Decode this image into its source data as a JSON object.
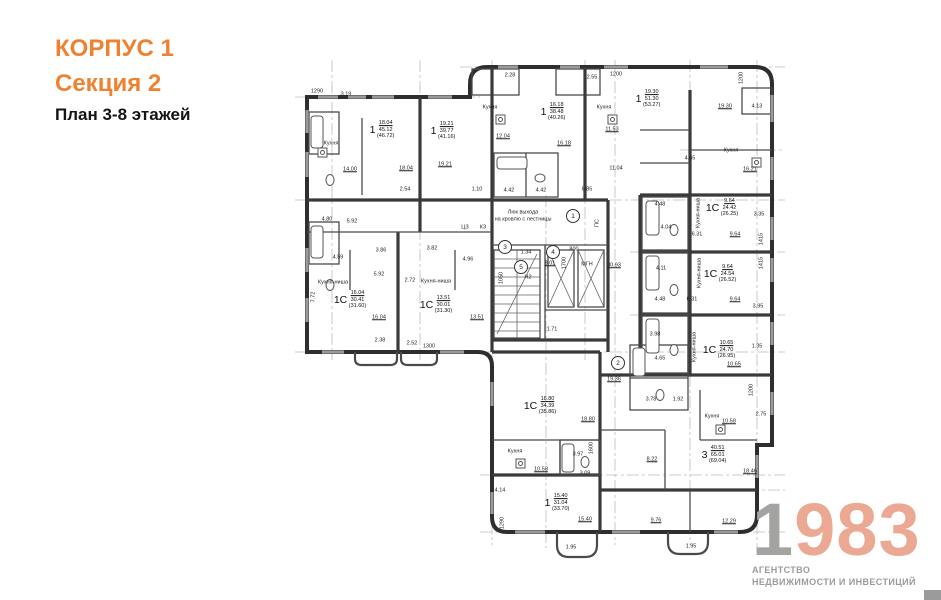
{
  "header": {
    "building": "КОРПУС 1",
    "section": "Секция 2",
    "plan_title": "План 3-8 этажей"
  },
  "logo": {
    "digit1": "1",
    "digits": "983",
    "tagline1": "АГЕНТСТВО",
    "tagline2": "НЕДВИЖИМОСТИ И ИНВЕСТИЦИЙ"
  },
  "colors": {
    "accent": "#ee8230",
    "logo_salmon": "#eba893",
    "logo_gray": "#9b9b9b",
    "ink": "#2e2e2e"
  },
  "plan": {
    "apartments": [
      {
        "type": "1",
        "a1": "18.04",
        "a2": "45.12",
        "a3": "(46.72)",
        "x": 382,
        "y": 130
      },
      {
        "type": "1",
        "a1": "19.21",
        "a2": "39.77",
        "a3": "(41.16)",
        "x": 443,
        "y": 131
      },
      {
        "type": "1",
        "a1": "16.18",
        "a2": "38.48",
        "a3": "(40.26)",
        "x": 553,
        "y": 112
      },
      {
        "type": "1",
        "a1": "19.30",
        "a2": "51.30",
        "a3": "(53.27)",
        "x": 648,
        "y": 99
      },
      {
        "type": "1С",
        "a1": "9.64",
        "a2": "24.42",
        "a3": "(26.25)",
        "x": 722,
        "y": 208
      },
      {
        "type": "1С",
        "a1": "9.64",
        "a2": "24.54",
        "a3": "(26.52)",
        "x": 720,
        "y": 274
      },
      {
        "type": "1С",
        "a1": "10.65",
        "a2": "24.70",
        "a3": "(26.95)",
        "x": 719,
        "y": 350
      },
      {
        "type": "3",
        "a1": "40.51",
        "a2": "65.01",
        "a3": "(69.04)",
        "x": 714,
        "y": 455
      },
      {
        "type": "1С",
        "a1": "18.80",
        "a2": "34.39",
        "a3": "(35.86)",
        "x": 540,
        "y": 406
      },
      {
        "type": "1",
        "a1": "15.40",
        "a2": "31.04",
        "a3": "(33.70)",
        "x": 557,
        "y": 503
      },
      {
        "type": "1С",
        "a1": "16.04",
        "a2": "30.41",
        "a3": "(31.60)",
        "x": 350,
        "y": 300
      },
      {
        "type": "1С",
        "a1": "13.51",
        "a2": "30.01",
        "a3": "(31.30)",
        "x": 436,
        "y": 305
      }
    ],
    "labels": [
      {
        "t": "1290",
        "x": 317,
        "y": 92
      },
      {
        "t": "3.19",
        "x": 346,
        "y": 95
      },
      {
        "t": "Кухня",
        "x": 331,
        "y": 144
      },
      {
        "t": "14.00",
        "x": 350,
        "y": 170,
        "u": 1
      },
      {
        "t": "18.04",
        "x": 406,
        "y": 169,
        "u": 1
      },
      {
        "t": "2.54",
        "x": 405,
        "y": 190
      },
      {
        "t": "19.21",
        "x": 445,
        "y": 165,
        "u": 1
      },
      {
        "t": "1.10",
        "x": 477,
        "y": 190
      },
      {
        "t": "4.80",
        "x": 327,
        "y": 220
      },
      {
        "t": "5.92",
        "x": 352,
        "y": 222
      },
      {
        "t": "4.59",
        "x": 338,
        "y": 258
      },
      {
        "t": "3.86",
        "x": 381,
        "y": 251
      },
      {
        "t": "3.82",
        "x": 432,
        "y": 249
      },
      {
        "t": "4.96",
        "x": 468,
        "y": 260
      },
      {
        "t": "5.92",
        "x": 379,
        "y": 275
      },
      {
        "t": "2.72",
        "x": 410,
        "y": 281
      },
      {
        "t": "7.72",
        "x": 314,
        "y": 297,
        "v": 1
      },
      {
        "t": "Кухня-ниша",
        "x": 333,
        "y": 283
      },
      {
        "t": "Кухня-ниша",
        "x": 436,
        "y": 282
      },
      {
        "t": "16.04",
        "x": 379,
        "y": 318,
        "u": 1
      },
      {
        "t": "13.51",
        "x": 477,
        "y": 318,
        "u": 1
      },
      {
        "t": "2.38",
        "x": 380,
        "y": 341
      },
      {
        "t": "2.52",
        "x": 412,
        "y": 344
      },
      {
        "t": "1300",
        "x": 429,
        "y": 347
      },
      {
        "t": "2.28",
        "x": 510,
        "y": 76
      },
      {
        "t": "Кухня",
        "x": 490,
        "y": 108
      },
      {
        "t": "12.04",
        "x": 503,
        "y": 137,
        "u": 1
      },
      {
        "t": "16.18",
        "x": 564,
        "y": 144,
        "u": 1
      },
      {
        "t": "2.55",
        "x": 592,
        "y": 78
      },
      {
        "t": "1200",
        "x": 616,
        "y": 75
      },
      {
        "t": "Кухня",
        "x": 604,
        "y": 108
      },
      {
        "t": "11.53",
        "x": 612,
        "y": 130,
        "u": 1
      },
      {
        "t": "11.04",
        "x": 616,
        "y": 169
      },
      {
        "t": "6.85",
        "x": 587,
        "y": 190
      },
      {
        "t": "4.42",
        "x": 509,
        "y": 191
      },
      {
        "t": "4.42",
        "x": 541,
        "y": 191
      },
      {
        "t": "ЦЗ",
        "x": 465,
        "y": 228
      },
      {
        "t": "КЗ",
        "x": 483,
        "y": 228
      },
      {
        "t": "1200",
        "x": 742,
        "y": 78,
        "v": 1
      },
      {
        "t": "19.30",
        "x": 725,
        "y": 107,
        "u": 1
      },
      {
        "t": "4.13",
        "x": 757,
        "y": 107
      },
      {
        "t": "Кухня",
        "x": 731,
        "y": 151
      },
      {
        "t": "16.21",
        "x": 750,
        "y": 170,
        "u": 1
      },
      {
        "t": "4.65",
        "x": 690,
        "y": 159
      },
      {
        "t": "4.48",
        "x": 660,
        "y": 205
      },
      {
        "t": "4.04",
        "x": 666,
        "y": 228
      },
      {
        "t": "6.31",
        "x": 697,
        "y": 235
      },
      {
        "t": "9.64",
        "x": 735,
        "y": 235,
        "u": 1
      },
      {
        "t": "3.35",
        "x": 759,
        "y": 215
      },
      {
        "t": "1415",
        "x": 762,
        "y": 239,
        "v": 1
      },
      {
        "t": "1415",
        "x": 762,
        "y": 263,
        "v": 1
      },
      {
        "t": "Кухня-ниша",
        "x": 699,
        "y": 213,
        "v": 1
      },
      {
        "t": "Кухня-ниша",
        "x": 700,
        "y": 273,
        "v": 1
      },
      {
        "t": "4.11",
        "x": 661,
        "y": 269
      },
      {
        "t": "6.31",
        "x": 692,
        "y": 300
      },
      {
        "t": "9.64",
        "x": 735,
        "y": 300,
        "u": 1
      },
      {
        "t": "3.95",
        "x": 758,
        "y": 307
      },
      {
        "t": "4.48",
        "x": 660,
        "y": 300
      },
      {
        "t": "3.98",
        "x": 655,
        "y": 335
      },
      {
        "t": "Кухня-ниша",
        "x": 695,
        "y": 347,
        "v": 1
      },
      {
        "t": "10.65",
        "x": 734,
        "y": 365,
        "u": 1
      },
      {
        "t": "1.35",
        "x": 757,
        "y": 347
      },
      {
        "t": "Люк выхода",
        "x": 523,
        "y": 213
      },
      {
        "t": "на кровлю с лестницы",
        "x": 523,
        "y": 220
      },
      {
        "t": "1.34",
        "x": 526,
        "y": 253
      },
      {
        "t": "8.01",
        "x": 550,
        "y": 264,
        "u": 1
      },
      {
        "t": "800",
        "x": 574,
        "y": 250
      },
      {
        "t": "1700",
        "x": 565,
        "y": 263,
        "v": 1
      },
      {
        "t": "МГН",
        "x": 587,
        "y": 265
      },
      {
        "t": "1050",
        "x": 502,
        "y": 278,
        "v": 1
      },
      {
        "t": "Н2",
        "x": 528,
        "y": 278
      },
      {
        "t": "ПС",
        "x": 598,
        "y": 223,
        "v": 1
      },
      {
        "t": "30.93",
        "x": 614,
        "y": 266,
        "u": 1
      },
      {
        "t": "1.71",
        "x": 552,
        "y": 330
      },
      {
        "t": "19.36",
        "x": 614,
        "y": 380,
        "u": 1
      },
      {
        "t": "4.65",
        "x": 660,
        "y": 359
      },
      {
        "t": "3.78",
        "x": 651,
        "y": 400
      },
      {
        "t": "1.92",
        "x": 678,
        "y": 400
      },
      {
        "t": "Кухня",
        "x": 712,
        "y": 417
      },
      {
        "t": "10.58",
        "x": 729,
        "y": 422,
        "u": 1
      },
      {
        "t": "2.75",
        "x": 761,
        "y": 415
      },
      {
        "t": "1200",
        "x": 752,
        "y": 390,
        "v": 1
      },
      {
        "t": "8.22",
        "x": 652,
        "y": 460,
        "u": 1
      },
      {
        "t": "18.46",
        "x": 750,
        "y": 472,
        "u": 1
      },
      {
        "t": "9.76",
        "x": 656,
        "y": 521,
        "u": 1
      },
      {
        "t": "12.29",
        "x": 729,
        "y": 522,
        "u": 1
      },
      {
        "t": "18.80",
        "x": 588,
        "y": 420,
        "u": 1
      },
      {
        "t": "Кухня",
        "x": 515,
        "y": 452
      },
      {
        "t": "10.58",
        "x": 541,
        "y": 470,
        "u": 1
      },
      {
        "t": "3.97",
        "x": 578,
        "y": 455
      },
      {
        "t": "3.09",
        "x": 585,
        "y": 474
      },
      {
        "t": "1600",
        "x": 592,
        "y": 448,
        "v": 1
      },
      {
        "t": "4.14",
        "x": 500,
        "y": 491
      },
      {
        "t": "1290",
        "x": 503,
        "y": 523,
        "v": 1
      },
      {
        "t": "15.40",
        "x": 585,
        "y": 520,
        "u": 1
      },
      {
        "t": "1.95",
        "x": 571,
        "y": 548
      },
      {
        "t": "1.95",
        "x": 691,
        "y": 547
      }
    ],
    "markers": [
      {
        "n": "1",
        "x": 573,
        "y": 216
      },
      {
        "n": "2",
        "x": 618,
        "y": 363
      },
      {
        "n": "3",
        "x": 505,
        "y": 247
      },
      {
        "n": "4",
        "x": 553,
        "y": 252
      },
      {
        "n": "5",
        "x": 521,
        "y": 267
      }
    ]
  }
}
